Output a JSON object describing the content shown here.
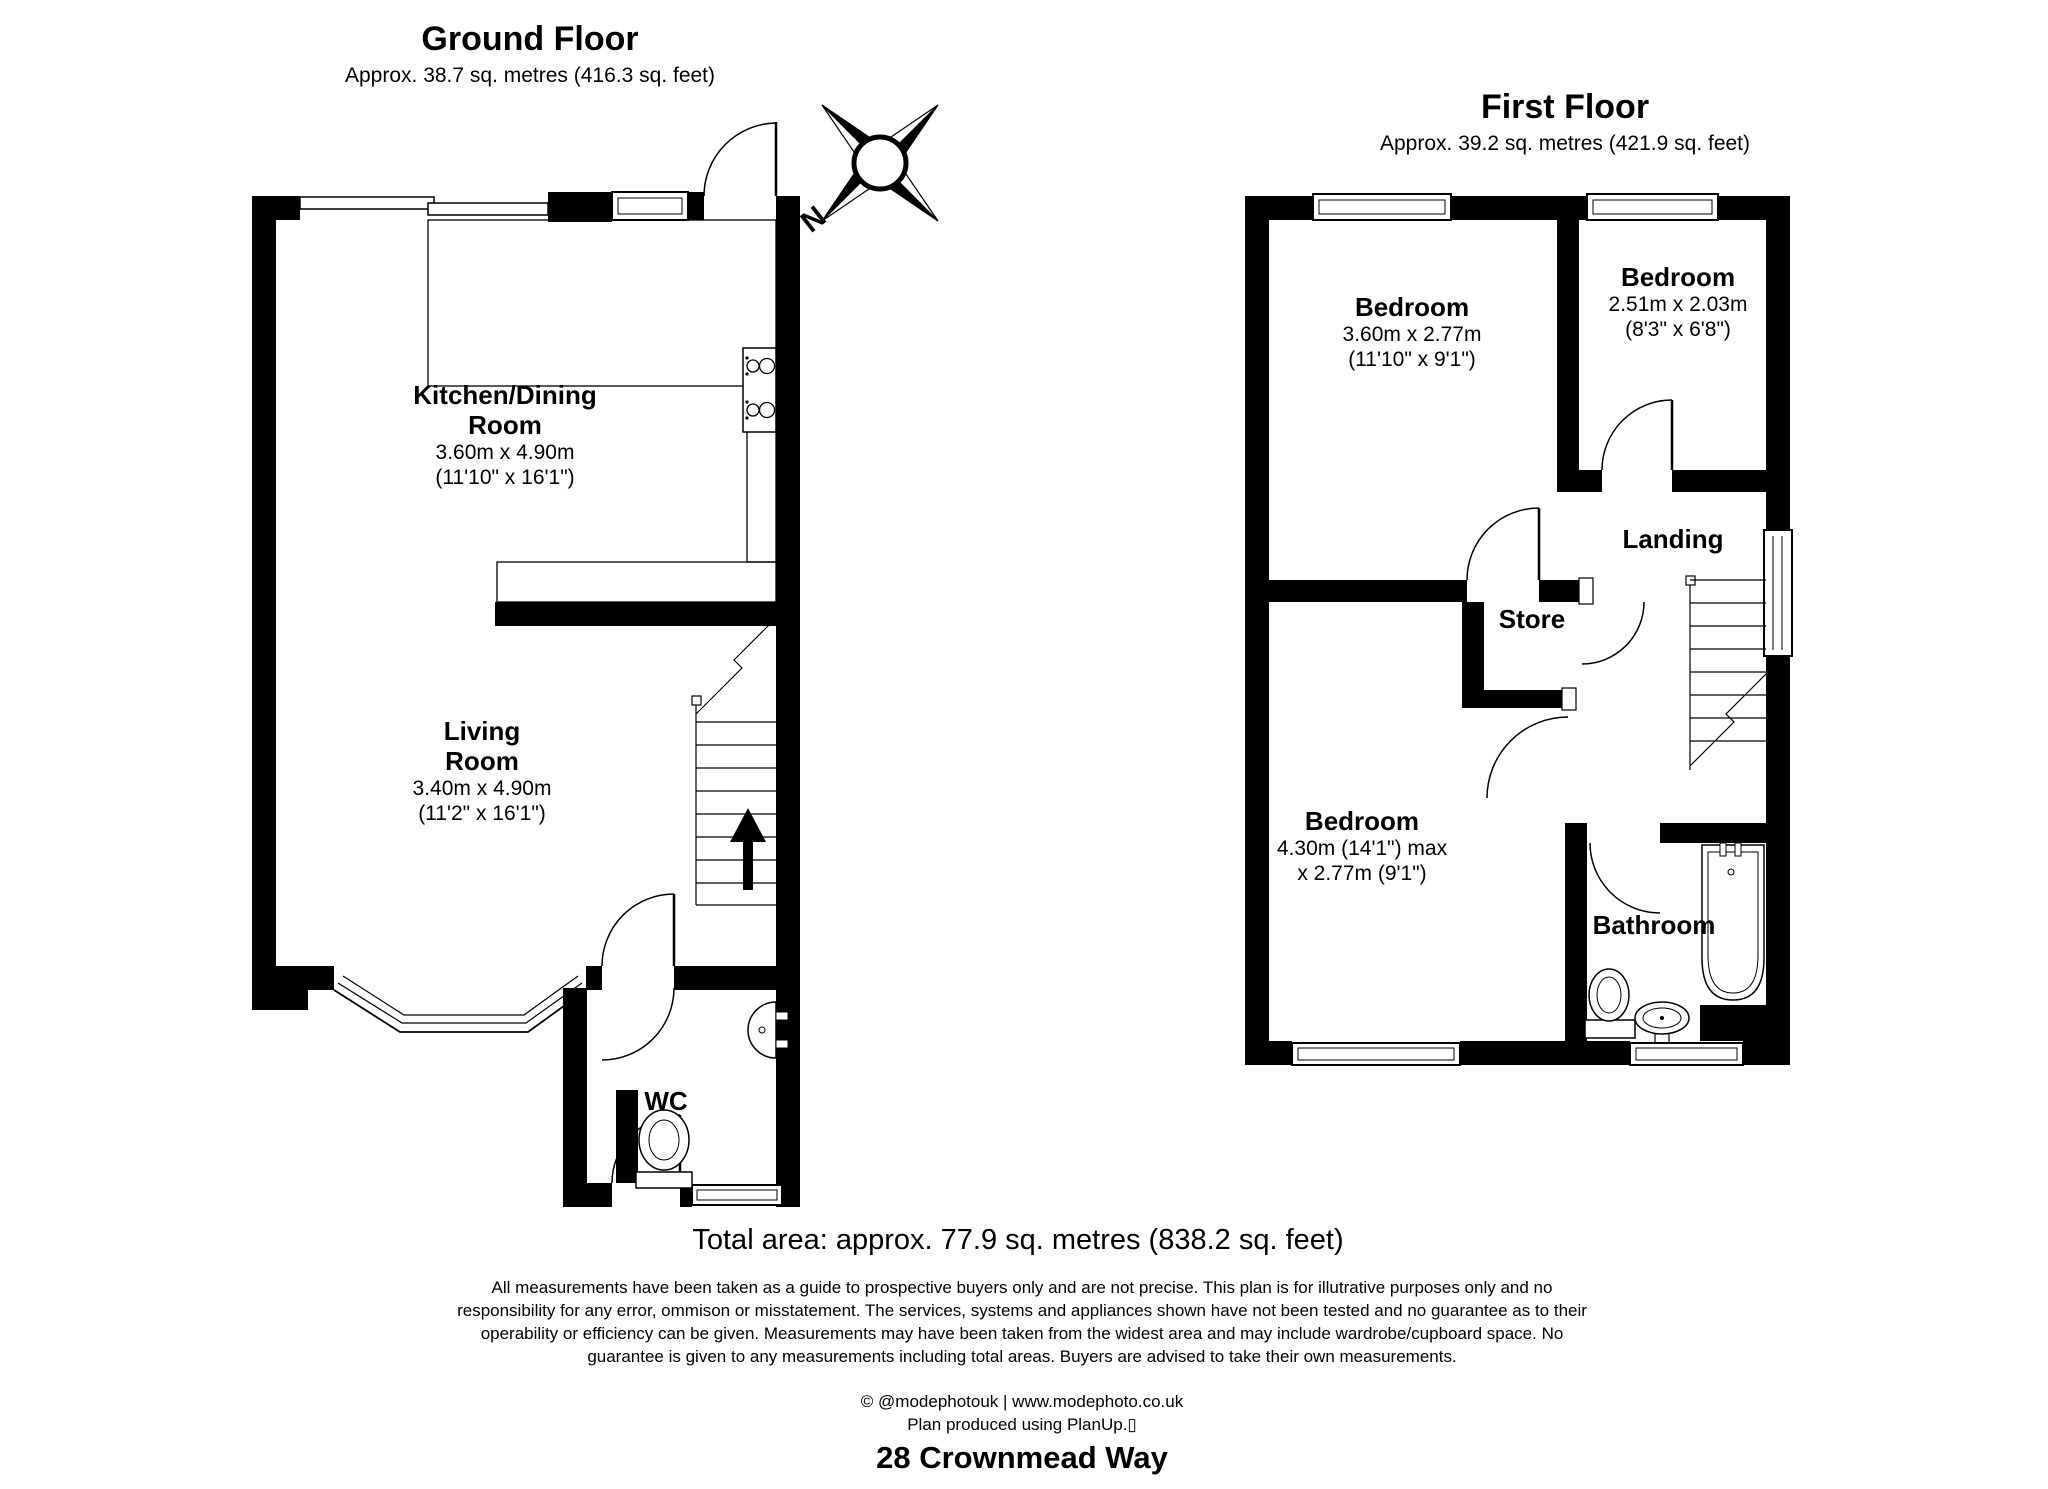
{
  "ground_floor": {
    "title": "Ground Floor",
    "subtitle": "Approx. 38.7 sq. metres (416.3 sq. feet)",
    "rooms": {
      "kitchen": {
        "name_line1": "Kitchen/Dining",
        "name_line2": "Room",
        "dims_metric": "3.60m x 4.90m",
        "dims_imperial": "(11'10\" x 16'1\")"
      },
      "living": {
        "name_line1": "Living",
        "name_line2": "Room",
        "dims_metric": "3.40m x 4.90m",
        "dims_imperial": "(11'2\" x 16'1\")"
      },
      "wc": {
        "name": "WC"
      }
    }
  },
  "first_floor": {
    "title": "First Floor",
    "subtitle": "Approx. 39.2 sq. metres (421.9 sq. feet)",
    "rooms": {
      "bedroom1": {
        "name": "Bedroom",
        "dims_metric": "3.60m x 2.77m",
        "dims_imperial": "(11'10\" x 9'1\")"
      },
      "bedroom2": {
        "name": "Bedroom",
        "dims_metric": "2.51m x 2.03m",
        "dims_imperial": "(8'3\" x 6'8\")"
      },
      "bedroom3": {
        "name": "Bedroom",
        "dims_line1": "4.30m (14'1\") max",
        "dims_line2": "x 2.77m (9'1\")"
      },
      "landing": {
        "name": "Landing"
      },
      "store": {
        "name": "Store"
      },
      "bathroom": {
        "name": "Bathroom"
      }
    }
  },
  "compass": {
    "north_label": "N"
  },
  "footer": {
    "total_area": "Total area: approx. 77.9 sq. metres (838.2 sq. feet)",
    "disclaimer_line1": "All measurements have been taken as a guide to prospective buyers only and are not precise. This plan is for illutrative purposes only and no",
    "disclaimer_line2": "responsibility for any error, ommison or misstatement. The services, systems and appliances shown have not been tested and no guarantee as to their",
    "disclaimer_line3": "operability or efficiency can be given. Measurements may have been taken from the widest area and may include wardrobe/cupboard space. No",
    "disclaimer_line4": "guarantee is given to any measurements including total areas. Buyers are advised to take their own measurements.",
    "credit": "© @modephotouk | www.modephoto.co.uk",
    "software": "Plan produced using PlanUp.▯",
    "address": "28 Crownmead Way"
  },
  "colors": {
    "wall": "#000000",
    "line": "#000000",
    "background": "#ffffff"
  }
}
